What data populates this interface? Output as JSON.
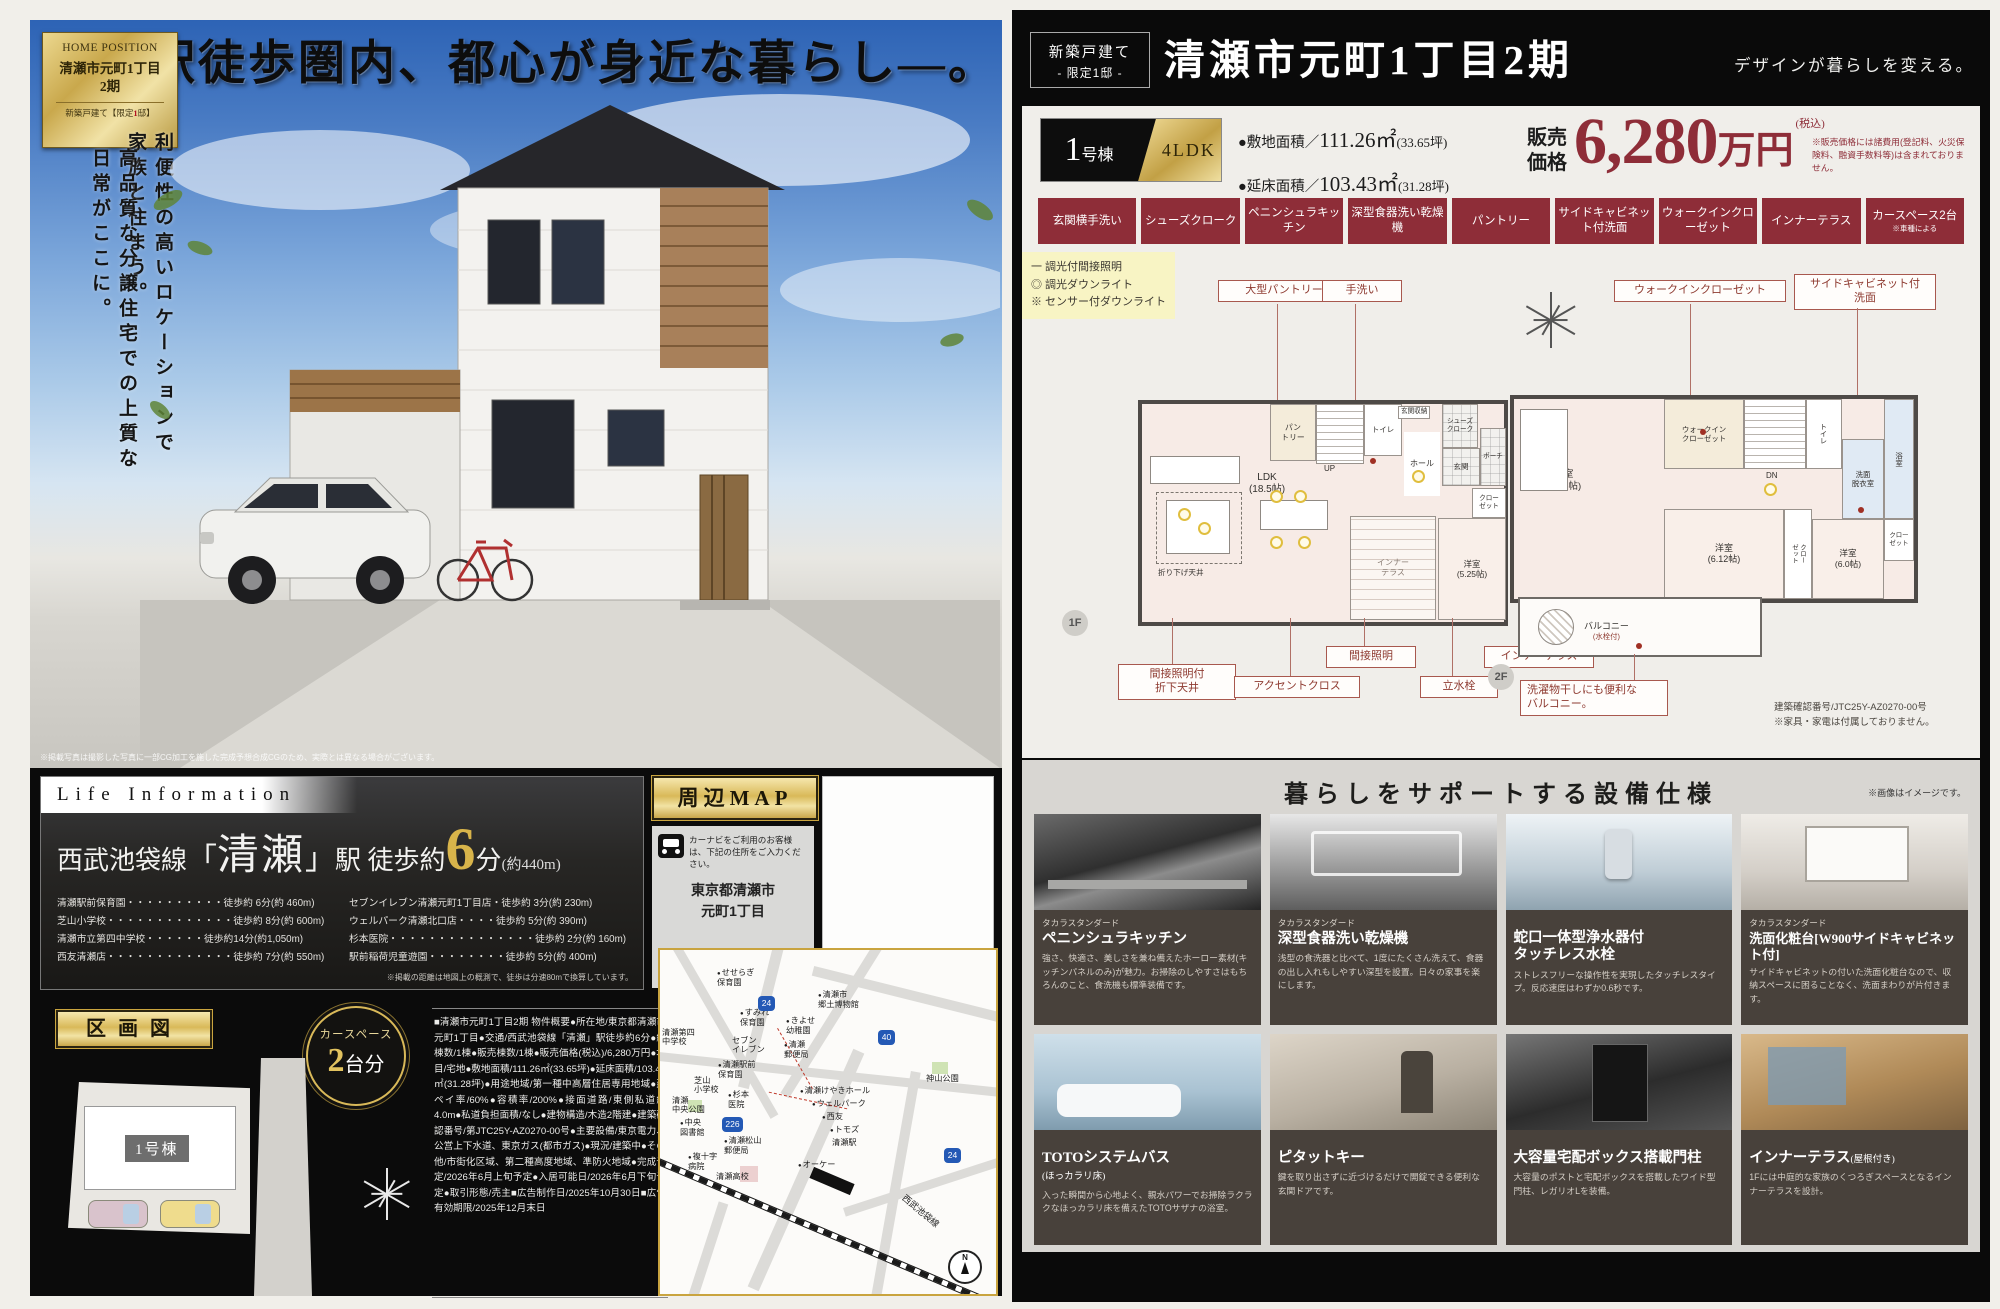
{
  "left": {
    "logo": {
      "brand": "HOME POSITION",
      "title1": "清瀬市元町1丁目",
      "title2": "2期",
      "sub_pre": "新築戸建て【限定",
      "sub_num": "1",
      "sub_post": "邸】"
    },
    "headline": "駅徒歩圏内、都心が身近な暮らし―。",
    "copy_right": "利便性の高いロケーションで家族と住まう。",
    "copy_left": "高品質な分譲住宅での上質な日常がここに。",
    "photo_caption": "※掲載写真は撮影した写真に一部CG加工を施した完成予想合成CGのため、実際とは異なる場合がございます。",
    "life": {
      "tab": "Life Information",
      "line_pre": "西武池袋線",
      "bracket_open": "「",
      "station": "清瀬",
      "bracket_close": "」",
      "line_mid": "駅 徒歩約",
      "minutes": "6",
      "min_unit": "分",
      "distance": "(約440m)",
      "col1": [
        "清瀬駅前保育園・・・・・・・・・・徒歩約 6分(約 460m)",
        "芝山小学校・・・・・・・・・・・・・徒歩約 8分(約 600m)",
        "清瀬市立第四中学校・・・・・・徒歩約14分(約1,050m)",
        "西友清瀬店・・・・・・・・・・・・・徒歩約 7分(約 550m)"
      ],
      "col2": [
        "セブンイレブン清瀬元町1丁目店・徒歩約 3分(約 230m)",
        "ウェルパーク清瀬北口店・・・・徒歩約 5分(約 390m)",
        "杉本医院・・・・・・・・・・・・・・・徒歩約 2分(約 160m)",
        "駅前稲荷児童遊園・・・・・・・・徒歩約 5分(約 400m)"
      ],
      "note": "※掲載の距離は地図上の概測で、徒歩は分速80mで換算しています。"
    },
    "map_section": {
      "title": "周辺MAP",
      "carnav": "カーナビをご利用のお客様は、下記の住所をご入力ください。",
      "address1": "東京都清瀬市",
      "address2": "元町1丁目"
    },
    "kukaku": {
      "title": "区画図",
      "badge_top": "カースペース",
      "badge_num": "2",
      "badge_unit": "台分",
      "lot": "1号棟"
    },
    "overview": "■清瀬市元町1丁目2期 物件概要●所在地/東京都清瀬市元町1丁目●交通/西武池袋線「清瀬」駅徒歩約6分●総棟数/1棟●販売棟数/1棟●販売価格(税込)/6,280万円●地目/宅地●敷地面積/111.26㎡(33.65坪)●延床面積/103.43㎡(31.28坪)●用途地域/第一種中高層住居専用地域●建ペイ率/60%●容積率/200%●接面道路/東側私道約4.0m●私道負担面積/なし●建物構造/木造2階建●建築確認番号/第JTC25Y-AZ0270-00号●主要設備/東京電力、公営上下水道、東京ガス(都市ガス)●現況/建築中●その他/市街化区域、第二種高度地域、準防火地域●完成予定/2026年6月上旬予定●入居可能日/2026年6月下旬予定●取引形態/売主■広告制作日/2025年10月30日■広告有効期限/2025年12月末日",
    "map": {
      "labels": [
        "せせらぎ\n保育園",
        "すみれ\n保育園",
        "清瀬市\n郷土博物館",
        "きよせ\n幼稚園",
        "清瀬第四\n中学校",
        "セブン\nイレブン",
        "清瀬\n郵便局",
        "清瀬駅前\n保育園",
        "神山公園",
        "芝山\n小学校",
        "杉本\n医院",
        "清瀬けやきホール",
        "ウェルパーク",
        "清瀬\n中央公園",
        "西友",
        "中央\n図書館",
        "トモズ",
        "清瀬駅",
        "清瀬松山\n郵便局",
        "複十字\n病院",
        "清瀬高校",
        "オーケー",
        "西武池袋線",
        "N"
      ],
      "badges": [
        "24",
        "40",
        "226",
        "24"
      ]
    }
  },
  "right": {
    "header": {
      "badge1": "新築戸建て",
      "badge2": "- 限定1邸 -",
      "title": "清瀬市元町1丁目2期",
      "tagline": "デザインが暮らしを変える。"
    },
    "price": {
      "unit_num": "1",
      "unit_suffix": "号棟",
      "layout": "4LDK",
      "land_label": "●敷地面積／",
      "land_num": "111.26㎡",
      "land_tsubo": "(33.65坪)",
      "floor_label": "●延床面積／",
      "floor_num": "103.43㎡",
      "floor_tsubo": "(31.28坪)",
      "price_l1": "販売",
      "price_l2": "価格",
      "amount": "6,280",
      "amount_unit": "万円",
      "tax": "(税込)",
      "note": "※販売価格には諸費用(登記料、火災保険料、融資手数料等)は含まれておりません。"
    },
    "features": [
      "玄関横手洗い",
      "シューズクローク",
      "ペニンシュラキッチン",
      "深型食器洗い乾燥機",
      "パントリー",
      "サイドキャビネット付洗面",
      "ウォークインクローゼット",
      "インナーテラス",
      "カースペース2台"
    ],
    "feature_note": "※車種による",
    "plans": {
      "f1_tag": "1F",
      "f2_tag": "2F",
      "f1_callouts": {
        "pantry": "大型パントリー",
        "tearai": "手洗い",
        "ceiling": "間接照明付\n折下天井",
        "accent": "アクセントクロス",
        "indirect": "間接照明",
        "tap": "立水栓",
        "terrace": "インナーテラス"
      },
      "f1_rooms": {
        "ldk": "LDK\n(18.5帖)",
        "pantry": "パン\nトリー",
        "up": "UP",
        "toilet": "トイレ",
        "hall": "ホール",
        "genkan": "玄関",
        "porch": "ポーチ",
        "sc": "シューズ\nクローク",
        "gshuno": "玄関収納",
        "closet": "クロー\nゼット",
        "yo525": "洋室\n(5.25帖)",
        "terrace": "インナー\nテラス",
        "ceiling": "折り下げ天井"
      },
      "f2_callouts": {
        "wic": "ウォークインクローゼット",
        "side": "サイドキャビネット付\n洗面"
      },
      "f2_rooms": {
        "yo925": "洋室\n(9.25帖)",
        "wic": "ウォークイン\nクローゼット",
        "dn": "DN",
        "toilet": "トイレ",
        "senmen": "洗面\n脱衣室",
        "bath": "浴室",
        "closet1": "クロー\nゼット",
        "yo612": "洋室\n(6.12帖)",
        "closet2": "クロー\nゼット",
        "yo60": "洋室\n(6.0帖)",
        "balcony": "バルコニー",
        "balcony_sub": "(水栓付)"
      },
      "balcony_note": "洗濯物干しにも便利な\nバルコニー。",
      "legend": [
        "一 調光付間接照明",
        "◎ 調光ダウンライト",
        "※ センサー付ダウンライト"
      ],
      "note1": "建築確認番号/JTC25Y-AZ0270-00号",
      "note2": "※家具・家電は付属しておりません。"
    },
    "equipment": {
      "title": "暮らしをサポートする設備仕様",
      "note": "※画像はイメージです。",
      "items": [
        {
          "brand": "タカラスタンダード",
          "name": "ペニンシュラキッチン",
          "name_sub": "",
          "desc": "強さ、快適さ、美しさを兼ね備えたホーロー素材(キッチンパネルのみ)が魅力。お掃除のしやすさはもちろんのこと、食洗機も標準装備です。"
        },
        {
          "brand": "タカラスタンダード",
          "name": "深型食器洗い乾燥機",
          "name_sub": "",
          "desc": "浅型の食洗器と比べて、1度にたくさん洗えて、食器の出し入れもしやすい深型を設置。日々の家事を楽にします。"
        },
        {
          "brand": "",
          "name": "蛇口一体型浄水器付\nタッチレス水栓",
          "name_sub": "",
          "desc": "ストレスフリーな操作性を実現したタッチレスタイプ。反応速度はわずか0.6秒です。"
        },
        {
          "brand": "タカラスタンダード",
          "name": "洗面化粧台[W900サイドキャビネット付]",
          "name_sub": "",
          "desc": "サイドキャビネットの付いた洗面化粧台なので、収納スペースに困ることなく、洗面まわりが片付きます。"
        },
        {
          "brand": "",
          "name": "TOTOシステムバス",
          "name_sub": "(ほっカラリ床)",
          "desc": "入った瞬間から心地よく、親水パワーでお掃除ラクラクなほっカラリ床を備えたTOTOサザナの浴室。"
        },
        {
          "brand": "",
          "name": "ピタットキー",
          "name_sub": "",
          "desc": "鍵を取り出さずに近づけるだけで開錠できる便利な玄関ドアです。"
        },
        {
          "brand": "",
          "name": "大容量宅配ボックス搭載門柱",
          "name_sub": "",
          "desc": "大容量のポストと宅配ボックスを搭載したワイド型門柱、レガリオLを装備。"
        },
        {
          "brand": "",
          "name": "インナーテラス",
          "name_sub": "(屋根付き)",
          "desc": "1Fには中庭的な家族のくつろぎスペースとなるインナーテラスを設計。"
        }
      ]
    }
  }
}
